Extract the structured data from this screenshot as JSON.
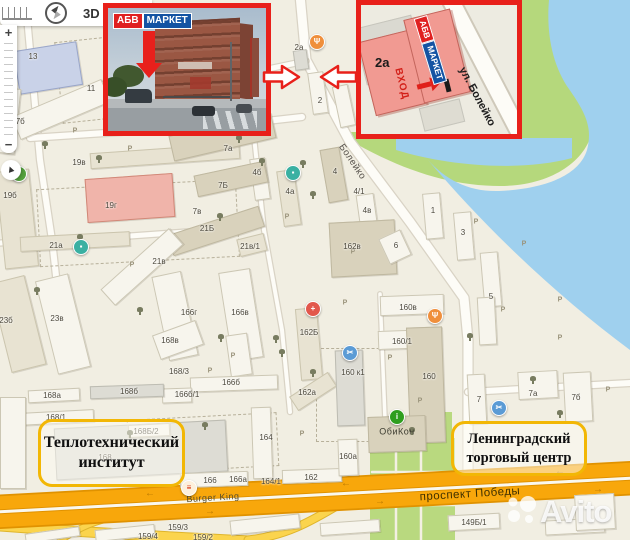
{
  "controls": {
    "threed": "3D",
    "zoom_in": "+",
    "zoom_out": "−",
    "locate_glyph": "▲"
  },
  "insets": {
    "photo": {
      "logo": {
        "abv": "АБВ",
        "market": "МАРКЕТ"
      }
    },
    "plan": {
      "label": "2а",
      "entrance": "ВХОД",
      "street": "ул. Болейко",
      "logo": {
        "abv": "АБВ",
        "market": "МАРКЕТ"
      }
    }
  },
  "callouts": [
    {
      "lines": [
        "Теплотехнический",
        "институт"
      ]
    },
    {
      "lines": [
        "Ленинградский",
        "торговый центр"
      ]
    }
  ],
  "watermark": {
    "text": "Avito"
  },
  "map": {
    "parking_char": "Р",
    "palette": {
      "water": "#9fd0ee",
      "green": "#b5d87c",
      "park": "#b9d97f",
      "path": "#f3f0e3",
      "casing": "#d9d3c5",
      "road": "#fdfcf7",
      "yellow": "#fbd44d",
      "yellow_casing": "#dfb52b",
      "hw_band": "#f8a70b",
      "hw_casing": "#e09200",
      "hw_median": "#faf8ee",
      "bld": {
        "t": [
          "#e8e3d2",
          "#cbc5ae"
        ],
        "d": [
          "#d9d2bc",
          "#bfb8a0"
        ],
        "w": [
          "#f7f5ed",
          "#ccc7b4"
        ],
        "p": [
          "#f0b4aa",
          "#d08878"
        ],
        "b": [
          "#c9d2e8",
          "#9aa6c8"
        ],
        "g": [
          "#dddcd4",
          "#bdbcb2"
        ]
      },
      "poi_styles": {
        "rest": {
          "bg": "#ef8f3c",
          "g": "Ψ",
          "fg": "#ffffff"
        },
        "med": {
          "bg": "#e2574c",
          "g": "+",
          "fg": "#ffffff"
        },
        "teal": {
          "bg": "#3ab0a2",
          "g": "▪",
          "fg": "#ffffff"
        },
        "blue": {
          "bg": "#5b9bd5",
          "g": "✂",
          "fg": "#ffffff"
        },
        "info": {
          "bg": "#2f9e1f",
          "g": "i",
          "fg": "#ffffff"
        },
        "grn": {
          "bg": "#55a23c",
          "g": "▪",
          "fg": "#ffffff"
        },
        "bk": {
          "bg": "#fdf0dc",
          "g": "≡",
          "fg": "#d62300"
        }
      }
    },
    "shapes": {
      "green": "M346,138 C400,170 450,186 500,186 C550,186 585,162 592,132 C598,106 582,92 568,70 C556,50 551,25 553,0 L521,0 L521,132 L346,132 Z",
      "river": "M549,0 C546,35 553,66 569,89 C585,112 593,127 587,150 C579,176 544,189 499,191 C469,192 446,180 428,160 C490,233 560,298 630,350 L630,0 Z",
      "pond": "M396,138 L572,138 L572,158 C520,172 448,166 396,150 Z",
      "park": "M428,412 L452,412 L452,438 L455,438 L455,540 L370,540 L370,438 L428,438 Z",
      "park_grid": [
        "M396,440 L396,540",
        "M421,440 L421,540",
        "M372,472 L455,472",
        "M372,505 L455,505"
      ]
    },
    "roads": [
      {
        "d": "M300,-5 L306,60 L350,142 L410,222 L464,298 L468,340 L468,470",
        "w": 9
      },
      {
        "d": "M306,61 L263,70",
        "w": 5
      },
      {
        "d": "M25,-5 L40,160 L52,240 L62,330",
        "w": 6
      },
      {
        "d": "M30,138 L240,124 L302,117",
        "w": 6
      },
      {
        "d": "M0,243 L130,236 L242,228",
        "w": 5
      },
      {
        "d": "M252,118 L264,230 L282,330 L290,412",
        "w": 4
      },
      {
        "d": "M468,392 L630,383",
        "w": 6
      },
      {
        "d": "M380,294 L386,444",
        "w": 3.5
      }
    ],
    "yellow_roads": [
      {
        "d": "M0,526 C80,532 170,537 250,541",
        "w": 9
      },
      {
        "d": "M248,540 C285,536 310,522 340,504",
        "w": 7
      },
      {
        "d": "M60,541 C78,528 95,521 112,518",
        "w": 5
      }
    ],
    "highway": {
      "bands": [
        {
          "d": "M-5,503 L635,469"
        },
        {
          "d": "M-5,521 L635,487"
        }
      ],
      "median": {
        "d": "M-5,512 L635,478"
      },
      "arrows": [
        [
          150,
          494,
          "←"
        ],
        [
          346,
          484,
          "←"
        ],
        [
          560,
          472,
          "←"
        ],
        [
          210,
          512,
          "→"
        ],
        [
          380,
          502,
          "→"
        ],
        [
          598,
          490,
          "→"
        ]
      ]
    },
    "buildings": [
      [
        112,
        36,
        106,
        24,
        -9,
        "d"
      ],
      [
        16,
        46,
        64,
        44,
        -9,
        "b"
      ],
      [
        224,
        40,
        18,
        28,
        -9,
        "t"
      ],
      [
        96,
        80,
        26,
        16,
        -9,
        "w"
      ],
      [
        2,
        88,
        16,
        66,
        6,
        "w"
      ],
      [
        12,
        97,
        98,
        25,
        -23,
        "w"
      ],
      [
        0,
        170,
        34,
        98,
        -6,
        "t"
      ],
      [
        90,
        148,
        150,
        16,
        -4,
        "t"
      ],
      [
        86,
        176,
        88,
        44,
        -4,
        "p"
      ],
      [
        20,
        234,
        110,
        15,
        -3,
        "t"
      ],
      [
        168,
        220,
        96,
        22,
        -18,
        "d"
      ],
      [
        238,
        236,
        28,
        18,
        -14,
        "t"
      ],
      [
        96,
        256,
        92,
        22,
        -42,
        "w"
      ],
      [
        0,
        278,
        36,
        92,
        -14,
        "t"
      ],
      [
        46,
        276,
        34,
        96,
        -14,
        "w"
      ],
      [
        160,
        273,
        30,
        86,
        -12,
        "w"
      ],
      [
        225,
        270,
        32,
        90,
        -9,
        "w"
      ],
      [
        298,
        308,
        22,
        72,
        -5,
        "t"
      ],
      [
        290,
        383,
        46,
        17,
        -33,
        "t"
      ],
      [
        324,
        148,
        20,
        54,
        -10,
        "d"
      ],
      [
        280,
        170,
        18,
        56,
        -8,
        "t"
      ],
      [
        252,
        158,
        16,
        42,
        -8,
        "w"
      ],
      [
        358,
        194,
        18,
        36,
        -8,
        "w"
      ],
      [
        170,
        124,
        105,
        26,
        -13,
        "d"
      ],
      [
        195,
        168,
        72,
        22,
        -12,
        "d"
      ],
      [
        424,
        193,
        18,
        46,
        -5,
        "w"
      ],
      [
        455,
        212,
        18,
        48,
        -5,
        "w"
      ],
      [
        482,
        252,
        18,
        55,
        -5,
        "w"
      ],
      [
        330,
        221,
        66,
        55,
        -3,
        "d"
      ],
      [
        383,
        233,
        24,
        28,
        -25,
        "w"
      ],
      [
        380,
        295,
        64,
        20,
        -2,
        "w"
      ],
      [
        378,
        330,
        58,
        19,
        -2,
        "w"
      ],
      [
        336,
        350,
        28,
        76,
        -2,
        "g"
      ],
      [
        408,
        327,
        36,
        116,
        -2,
        "d"
      ],
      [
        155,
        327,
        46,
        26,
        -20,
        "w"
      ],
      [
        228,
        334,
        22,
        42,
        -8,
        "w"
      ],
      [
        190,
        376,
        88,
        15,
        -2,
        "w"
      ],
      [
        162,
        388,
        30,
        15,
        -2,
        "w"
      ],
      [
        90,
        385,
        74,
        13,
        -2,
        "g"
      ],
      [
        28,
        389,
        52,
        13,
        -3,
        "w"
      ],
      [
        18,
        411,
        76,
        13,
        -3,
        "w"
      ],
      [
        55,
        424,
        172,
        52,
        -3,
        "g"
      ],
      [
        128,
        424,
        42,
        13,
        -3,
        "w"
      ],
      [
        252,
        407,
        20,
        72,
        -2,
        "w"
      ],
      [
        0,
        397,
        26,
        92,
        0,
        "w"
      ],
      [
        180,
        472,
        68,
        15,
        -2,
        "w"
      ],
      [
        282,
        469,
        60,
        14,
        -2,
        "w"
      ],
      [
        338,
        439,
        20,
        37,
        -2,
        "w"
      ],
      [
        368,
        416,
        58,
        36,
        -2,
        "d"
      ],
      [
        468,
        374,
        18,
        50,
        -3,
        "w"
      ],
      [
        518,
        371,
        40,
        28,
        -3,
        "w"
      ],
      [
        564,
        372,
        28,
        50,
        -3,
        "w"
      ],
      [
        478,
        297,
        18,
        48,
        -3,
        "w"
      ],
      [
        310,
        72,
        16,
        42,
        -8,
        "w"
      ],
      [
        294,
        50,
        14,
        20,
        -8,
        "g"
      ],
      [
        336,
        85,
        16,
        42,
        -12,
        "w"
      ],
      [
        230,
        517,
        70,
        15,
        -6,
        "w"
      ],
      [
        320,
        521,
        60,
        13,
        -4,
        "w"
      ],
      [
        545,
        519,
        60,
        15,
        -3,
        "w"
      ],
      [
        575,
        494,
        40,
        36,
        -3,
        "w"
      ],
      [
        448,
        514,
        52,
        16,
        -3,
        "w"
      ],
      [
        95,
        527,
        60,
        12,
        -6,
        "w"
      ],
      [
        25,
        530,
        55,
        10,
        -8,
        "w"
      ]
    ],
    "dashed": [
      [
        58,
        32,
        190,
        80,
        -6
      ],
      [
        38,
        184,
        198,
        76,
        -3
      ],
      [
        316,
        348,
        102,
        92,
        0
      ],
      [
        128,
        416,
        148,
        52,
        -3
      ]
    ],
    "building_labels": [
      [
        "1",
        52,
        24
      ],
      [
        "13",
        33,
        57
      ],
      [
        "11",
        91,
        89
      ],
      [
        "17б",
        18,
        122
      ],
      [
        "19в",
        79,
        163
      ],
      [
        "19б",
        10,
        196
      ],
      [
        "19г",
        111,
        206
      ],
      [
        "21а",
        56,
        246
      ],
      [
        "7а",
        228,
        149
      ],
      [
        "7Б",
        223,
        186
      ],
      [
        "7в",
        197,
        212
      ],
      [
        "21Б",
        207,
        229
      ],
      [
        "21в/1",
        250,
        247
      ],
      [
        "21в",
        159,
        262
      ],
      [
        "2а",
        299,
        48
      ],
      [
        "2",
        320,
        101
      ],
      [
        "4",
        335,
        172
      ],
      [
        "4а",
        290,
        192
      ],
      [
        "4/1",
        359,
        192
      ],
      [
        "4б",
        257,
        173
      ],
      [
        "4в",
        367,
        211
      ],
      [
        "1",
        433,
        211
      ],
      [
        "3",
        463,
        233
      ],
      [
        "5",
        491,
        297
      ],
      [
        "162в",
        352,
        247
      ],
      [
        "6",
        396,
        246
      ],
      [
        "23б",
        6,
        321
      ],
      [
        "23в",
        57,
        319
      ],
      [
        "166г",
        189,
        313
      ],
      [
        "166в",
        240,
        313
      ],
      [
        "162Б",
        309,
        333
      ],
      [
        "162а",
        307,
        393
      ],
      [
        "160в",
        408,
        308
      ],
      [
        "160/1",
        402,
        342
      ],
      [
        "160 к1",
        353,
        373
      ],
      [
        "160",
        429,
        377
      ],
      [
        "168в",
        170,
        341
      ],
      [
        "168/3",
        179,
        372
      ],
      [
        "168б",
        129,
        392
      ],
      [
        "166б/1",
        187,
        395
      ],
      [
        "166б",
        231,
        383
      ],
      [
        "168а",
        52,
        396
      ],
      [
        "168/1",
        56,
        418
      ],
      [
        "168Б/2",
        146,
        432
      ],
      [
        "168",
        105,
        458
      ],
      [
        "164",
        266,
        438
      ],
      [
        "166",
        210,
        481
      ],
      [
        "166а",
        238,
        480
      ],
      [
        "164/1",
        271,
        482
      ],
      [
        "162",
        311,
        478
      ],
      [
        "160а",
        348,
        457
      ],
      [
        "7",
        479,
        400
      ],
      [
        "7а",
        533,
        394
      ],
      [
        "7б",
        576,
        398
      ],
      [
        "159/3",
        178,
        528
      ],
      [
        "159/4",
        148,
        537
      ],
      [
        "159/2",
        203,
        538
      ],
      [
        "149Б/1",
        474,
        523
      ]
    ],
    "street_labels": [
      [
        "Болейко",
        352,
        162,
        56,
        9.5,
        "#55504a"
      ],
      [
        "проспект Победы",
        470,
        495,
        -3.5,
        11.5,
        "#3f3000"
      ],
      [
        "Burger King",
        213,
        498,
        -3.5,
        9,
        "#574d2c"
      ],
      [
        "ОбиКон",
        397,
        432,
        0,
        9,
        "#3c3c30"
      ]
    ],
    "parking": [
      [
        75,
        131
      ],
      [
        130,
        149
      ],
      [
        246,
        123
      ],
      [
        287,
        217
      ],
      [
        345,
        303
      ],
      [
        390,
        358
      ],
      [
        420,
        401
      ],
      [
        524,
        244
      ],
      [
        560,
        338
      ],
      [
        233,
        356
      ],
      [
        132,
        265
      ],
      [
        302,
        434
      ],
      [
        476,
        222
      ],
      [
        503,
        310
      ],
      [
        353,
        252
      ],
      [
        210,
        371
      ],
      [
        560,
        300
      ],
      [
        608,
        390
      ]
    ],
    "trees": [
      [
        45,
        145
      ],
      [
        99,
        159
      ],
      [
        80,
        238
      ],
      [
        303,
        164
      ],
      [
        313,
        195
      ],
      [
        220,
        217
      ],
      [
        239,
        139
      ],
      [
        262,
        162
      ],
      [
        221,
        338
      ],
      [
        276,
        339
      ],
      [
        313,
        373
      ],
      [
        205,
        426
      ],
      [
        282,
        353
      ],
      [
        412,
        431
      ],
      [
        470,
        337
      ],
      [
        533,
        380
      ],
      [
        130,
        434
      ],
      [
        37,
        291
      ],
      [
        268,
        122
      ],
      [
        237,
        131
      ],
      [
        560,
        414
      ],
      [
        140,
        311
      ]
    ],
    "pois": [
      [
        317,
        42,
        "rest"
      ],
      [
        435,
        316,
        "rest"
      ],
      [
        313,
        309,
        "med"
      ],
      [
        81,
        247,
        "teal"
      ],
      [
        293,
        173,
        "teal"
      ],
      [
        350,
        353,
        "blue"
      ],
      [
        499,
        408,
        "blue"
      ],
      [
        397,
        417,
        "info"
      ],
      [
        19,
        174,
        "grn"
      ],
      [
        189,
        488,
        "bk"
      ]
    ]
  }
}
